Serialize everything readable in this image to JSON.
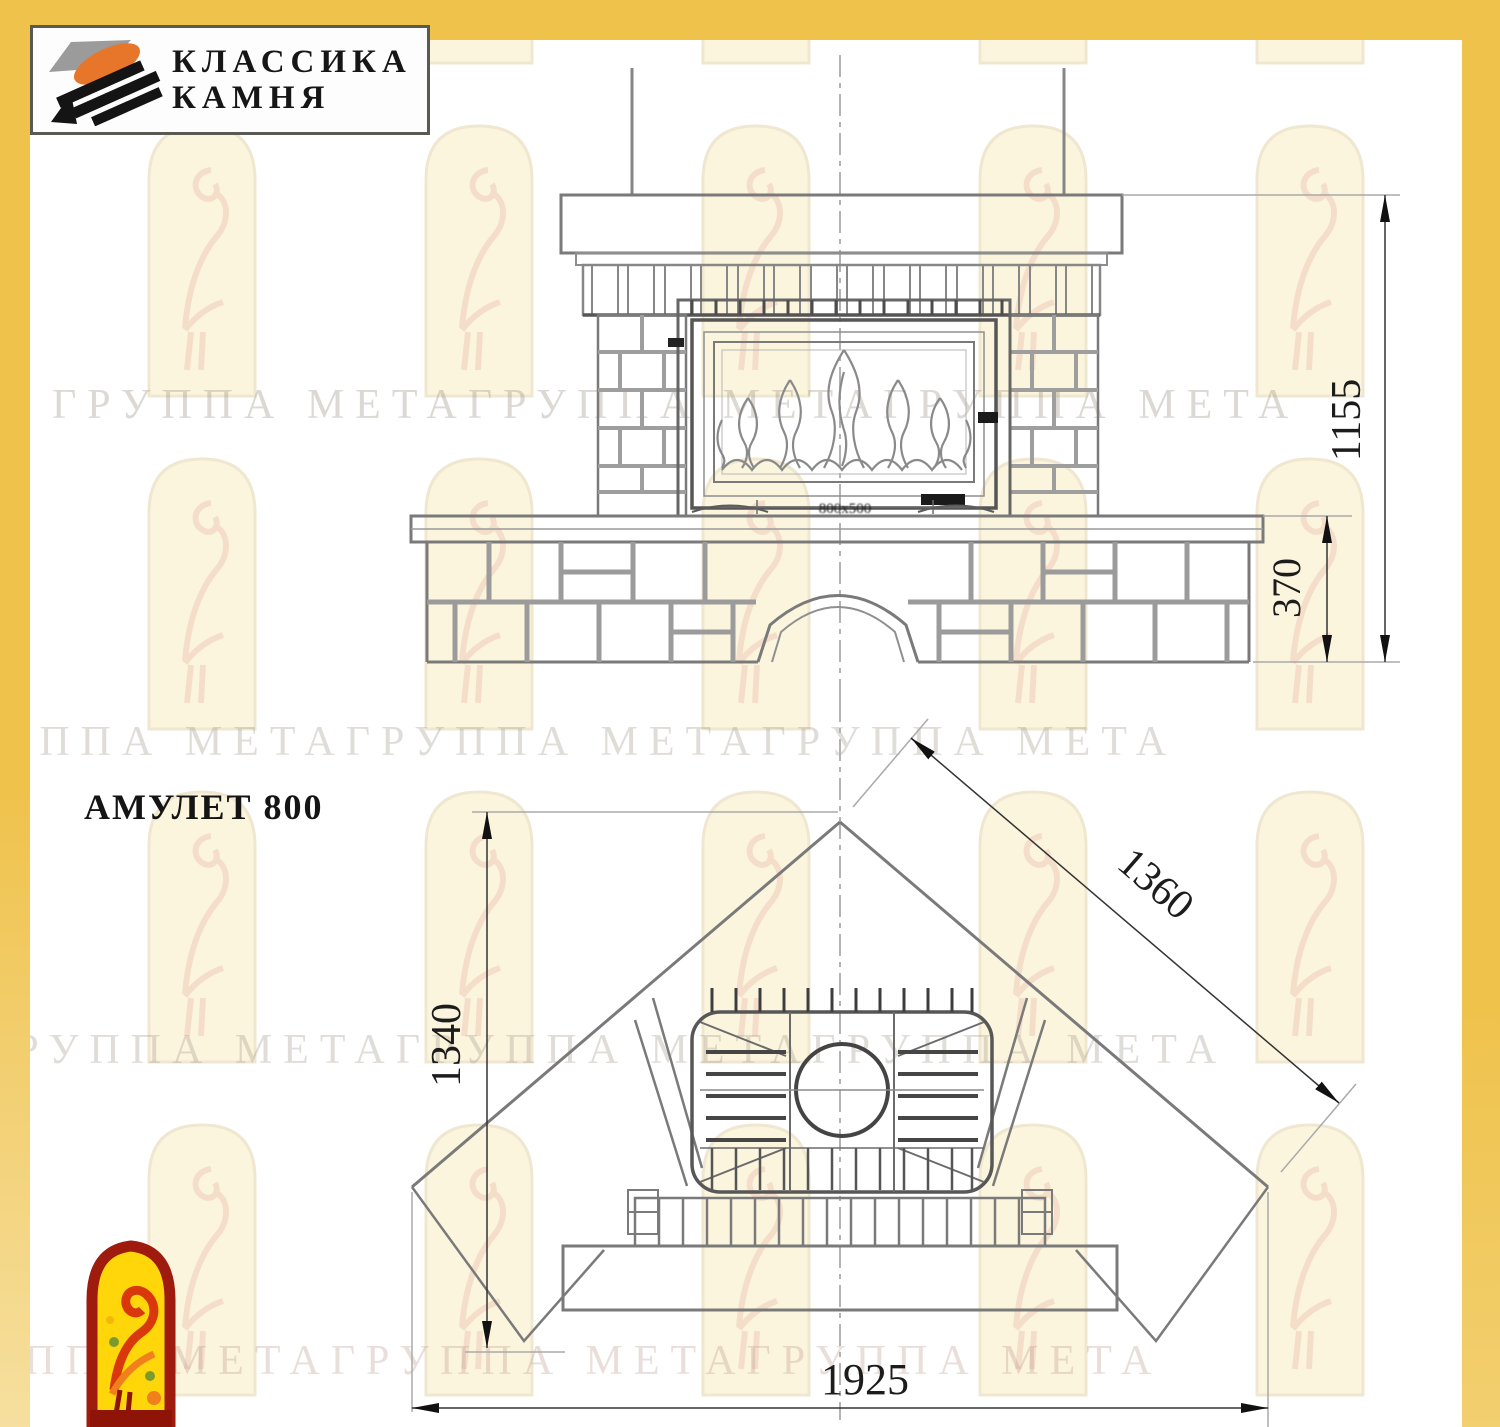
{
  "brand": {
    "name_line1": "КЛАССИКА",
    "name_line2": "КАМНЯ"
  },
  "title": "АМУЛЕТ 800",
  "watermark": {
    "row": "ГРУППА МЕТАГРУППА МЕТАГРУППА МЕТА"
  },
  "front_view": {
    "height_mm": "1155",
    "bench_height_mm": "370",
    "insert_label": "800x500"
  },
  "plan_view": {
    "depth_mm": "1340",
    "diagonal_mm": "1360",
    "width_mm": "1925"
  },
  "colors": {
    "border_yellow": "#EFC24B",
    "logo_red": "#9E1B0E",
    "logo_yellow": "#FFD60A",
    "stone_orange": "#E8762A",
    "drawing_line": "#777777"
  }
}
